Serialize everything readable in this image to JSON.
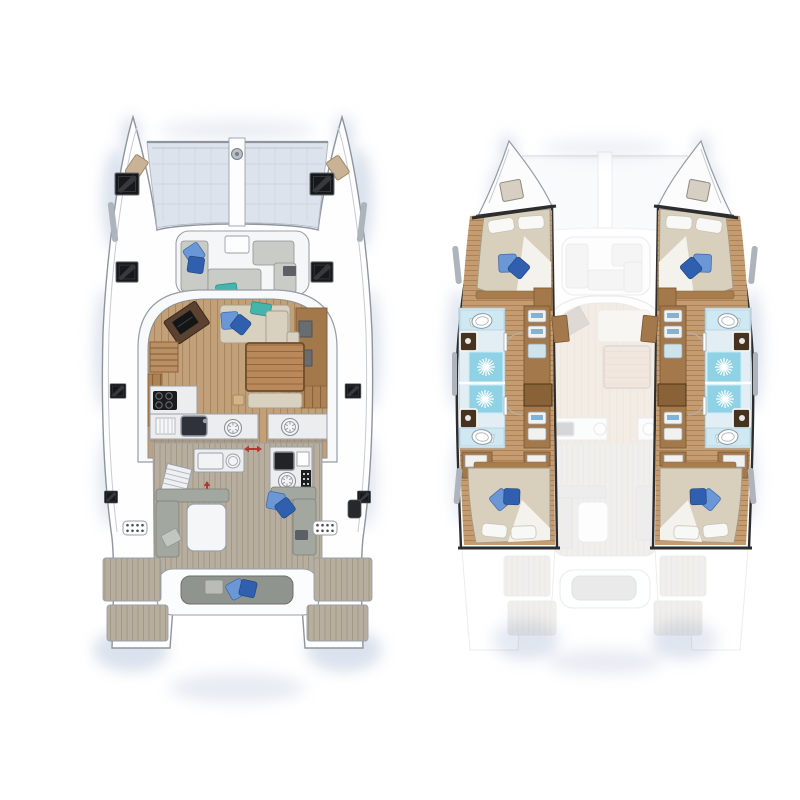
{
  "page": {
    "background": "#ffffff",
    "description": "Catamaran yacht floor plan with two top-down views: deck plan (left) and hull accommodation plan (right)",
    "left_view_label": "deck plan",
    "right_view_label": "hull accommodation plan"
  },
  "colors": {
    "shadow": "#b7c5db",
    "hull_outline": "#8e959e",
    "bold_outline": "#2c2d2f",
    "trampoline": "#dde3ec",
    "salon_wood": "#c2a078",
    "salon_wood_line": "#aa8760",
    "teak": "#b7ae9f",
    "teak_line": "#a29886",
    "hull_wood": "#c49c70",
    "hull_wood_line": "#ab8258",
    "slat_wood": "#ad8254",
    "slat_wood_line": "#8a6238",
    "table_wood": "#b9895c",
    "cushion_beige": "#d8d1c0",
    "cushion_gray": "#a2a7a0",
    "cushion_light_gray": "#c9ccc6",
    "pillow_blue_light": "#6b97d6",
    "pillow_blue_dark": "#2f5fae",
    "pillow_teal": "#45b5ab",
    "shower_blue": "#8fd2e6",
    "bath_tile": "#e2eef3",
    "vanity_blue": "#cfe9f2",
    "wood_cabinet": "#a3794c",
    "wood_dark": "#8a6238",
    "wood_trim": "#a97c4e",
    "desk_brown": "#5a4130",
    "duvet": "#d8cfbc",
    "hatch_black": "#17181a",
    "counter_white": "#ecedee",
    "sink_dark": "#2f3339",
    "red_arrow": "#b9342c"
  },
  "deck_plan": {
    "features": [
      "trampoline",
      "anchor-windlass",
      "bow-crossbeam",
      "deck-hatches",
      "forward-cockpit-seating",
      "blue-pillows",
      "teal-pillow",
      "salon",
      "chart-table-with-laptop",
      "l-shaped-sofa",
      "coffee-table",
      "galley-stove",
      "galley-sink",
      "round-deck-vents",
      "companionway-stairs",
      "sliding-door-arrows",
      "wet-bar-counter",
      "outdoor-grill-module",
      "cockpit-bench",
      "cockpit-table",
      "cockpit-lounge",
      "aft-bench",
      "transom-steps",
      "side-deck-vents"
    ]
  },
  "hull_plan": {
    "cabins": 4,
    "bathrooms": 4,
    "features": [
      "port-forward-cabin",
      "port-forward-bathroom",
      "port-aft-bathroom",
      "port-aft-cabin",
      "starboard-forward-cabin",
      "starboard-forward-bathroom",
      "starboard-aft-bathroom",
      "starboard-aft-cabin",
      "double-beds-with-pillows",
      "shower-stalls-with-drain",
      "toilets",
      "vanity-sinks",
      "wardrobe-cabinets",
      "companionway-steps",
      "hull-windows",
      "section-cut-lines",
      "ghosted-deck-overlay"
    ]
  }
}
